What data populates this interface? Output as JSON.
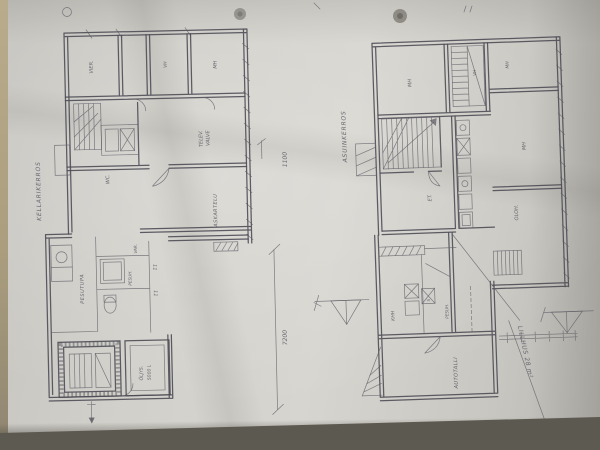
{
  "left_plan": {
    "caption": "KELLARIKERROS",
    "rooms": {
      "room1": "VIER.",
      "room2": "VH",
      "room3": "MH",
      "tv_line1": "TELEV.",
      "tv_line2": "VALVE",
      "wc": "WC.",
      "hobby": "ASKARTELU",
      "laundry": "PESUTUPA",
      "wash": "PESUH.",
      "storage": "VAR.",
      "tank_line1": "ÖLJYS.",
      "tank_line2": "5000 L"
    },
    "dimensions": {
      "width_label": "7200",
      "height_label": "1100"
    },
    "tick_marks": [
      "11",
      "11"
    ]
  },
  "right_plan": {
    "caption": "ASUINKERROS",
    "rooms": {
      "bed1": "MH",
      "closet": "VH",
      "bed2": "MH",
      "bed3": "MH",
      "living": "OLOH.",
      "entry": "ET.",
      "utility": "KHH",
      "sauna": "S",
      "wash": "PESUH.",
      "garage": "AUTOTALLI"
    },
    "note": "LILLHUS 28 m²"
  }
}
